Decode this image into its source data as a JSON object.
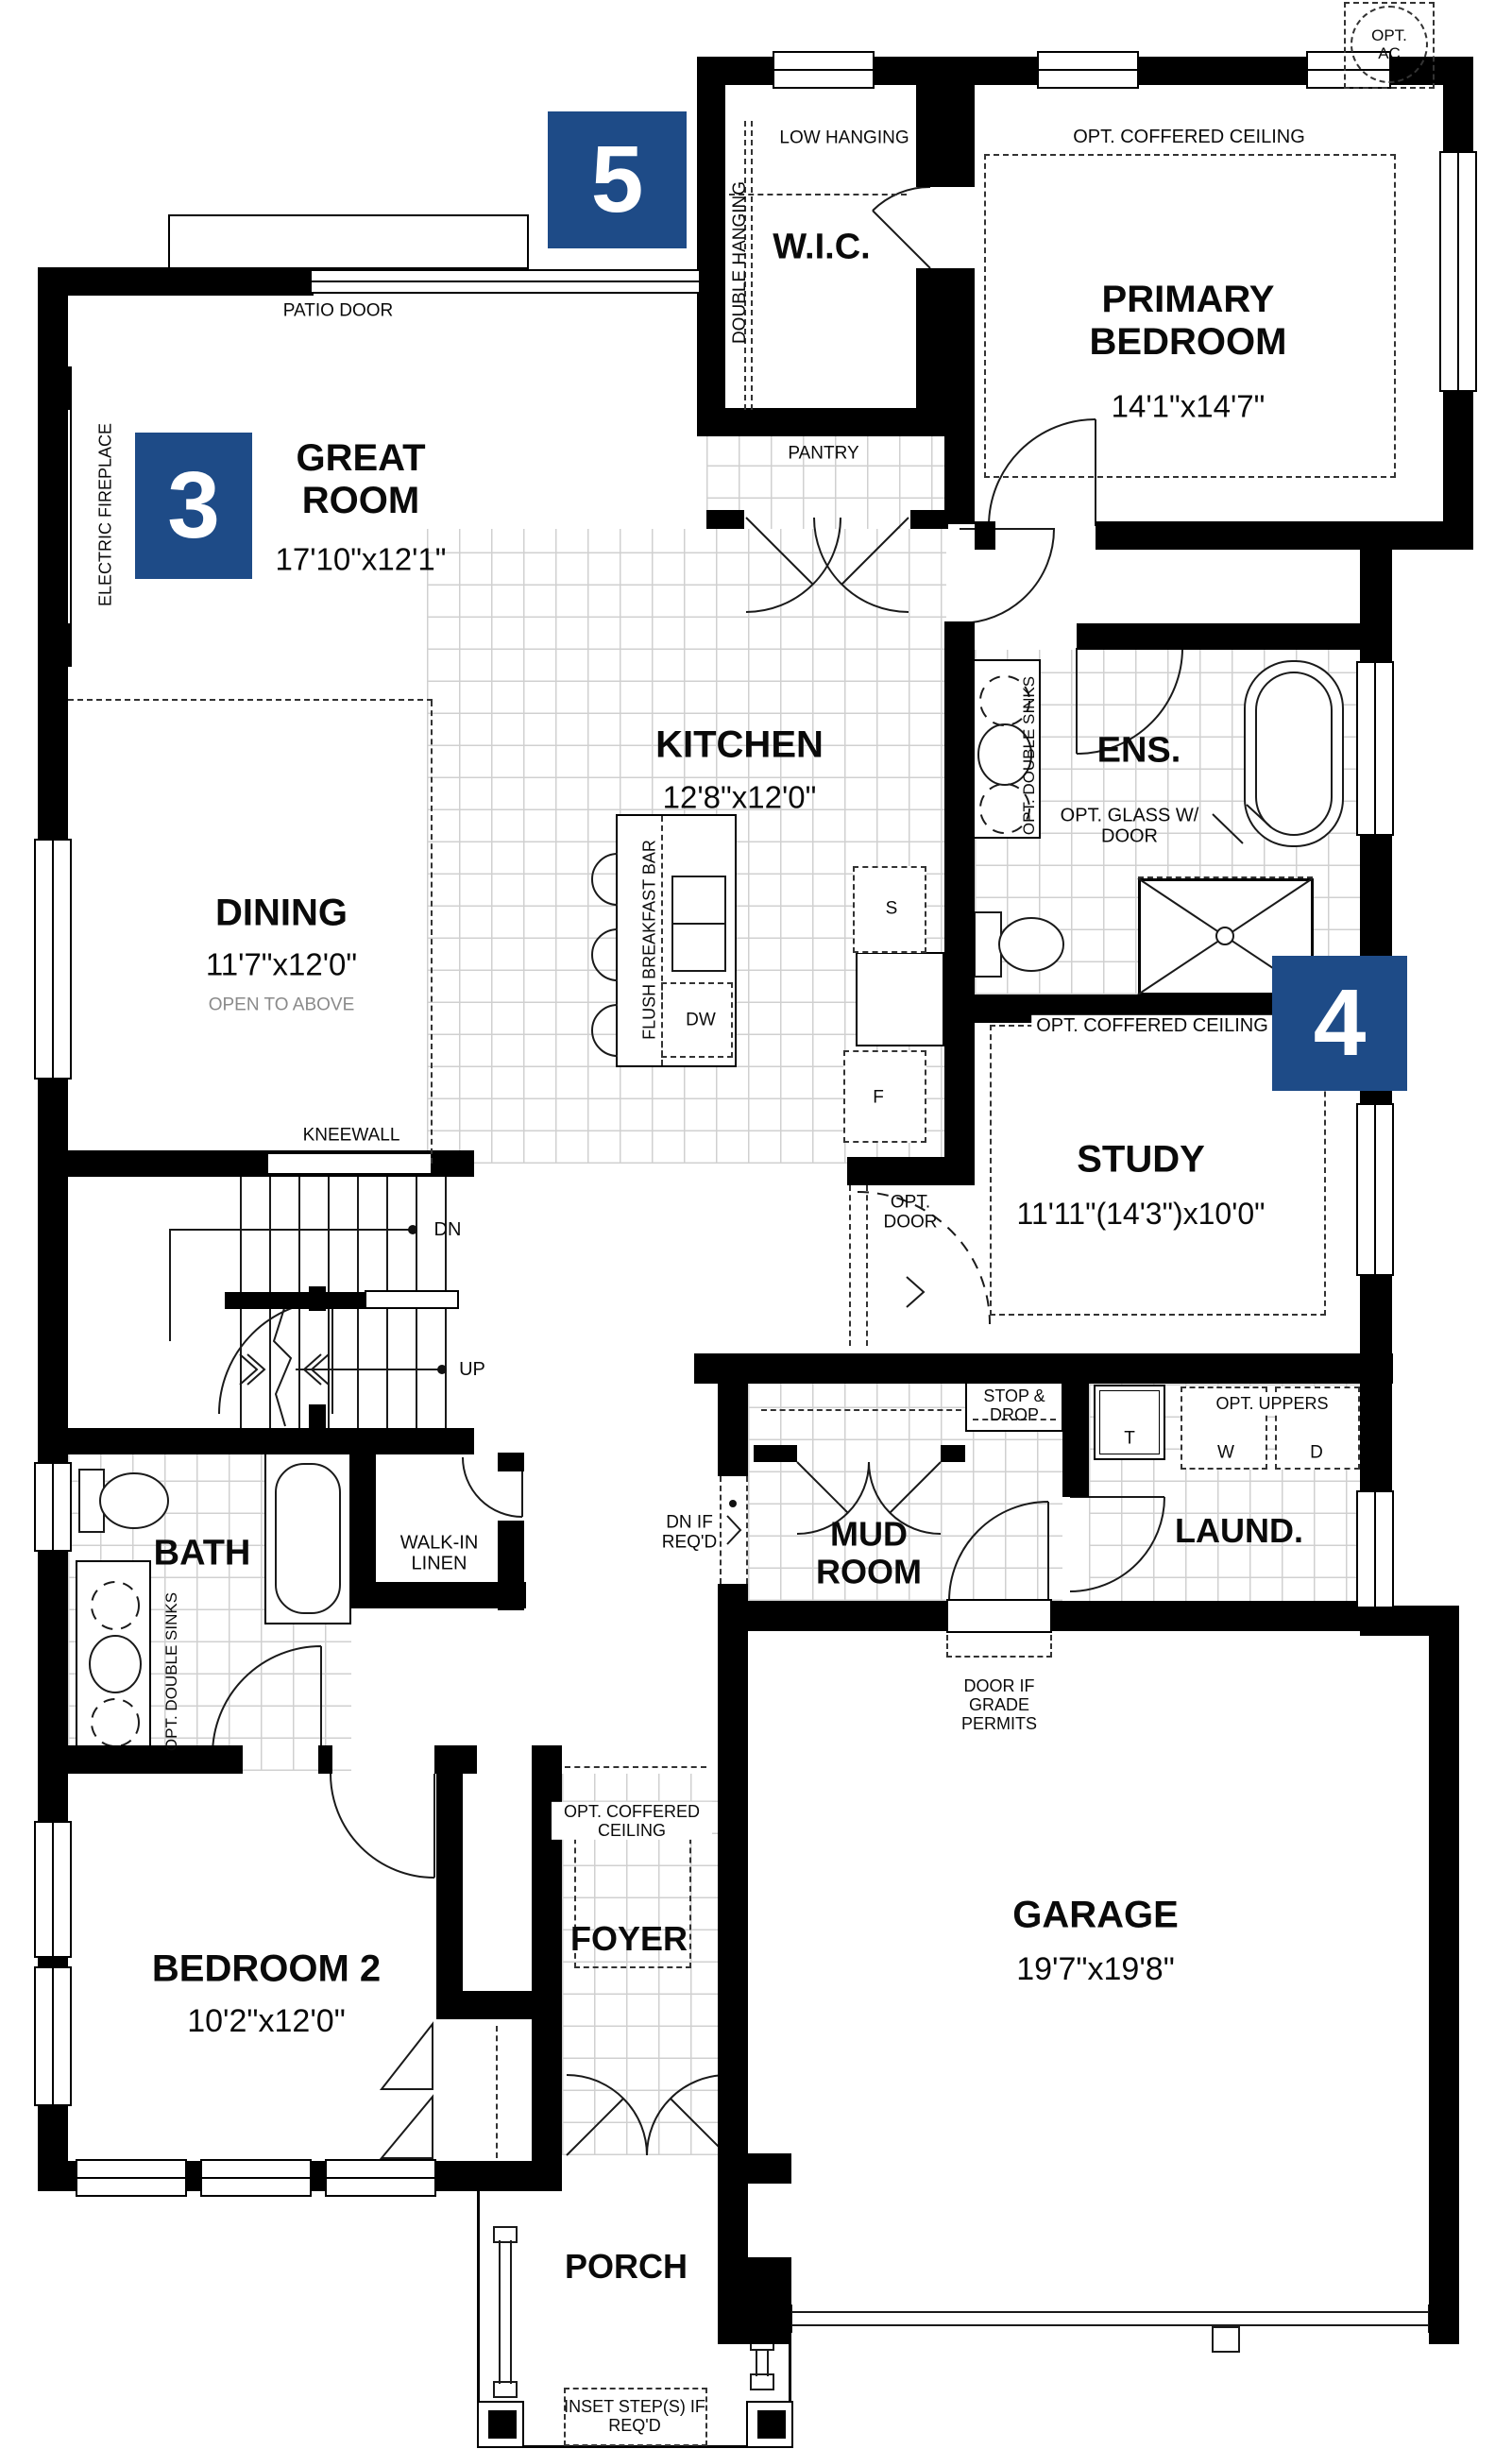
{
  "colors": {
    "marker_blue": "#1e4b87",
    "wall": "#000000"
  },
  "markers": {
    "five": "5",
    "three": "3",
    "four": "4"
  },
  "rooms": {
    "wic": {
      "name": "W.I.C."
    },
    "primary": {
      "name": "PRIMARY BEDROOM",
      "dims": "14'1\"x14'7\""
    },
    "great": {
      "name": "GREAT ROOM",
      "dims": "17'10\"x12'1\""
    },
    "kitchen": {
      "name": "KITCHEN",
      "dims": "12'8\"x12'0\""
    },
    "dining": {
      "name": "DINING",
      "dims": "11'7\"x12'0\"",
      "note": "OPEN TO ABOVE"
    },
    "ens": {
      "name": "ENS."
    },
    "study": {
      "name": "STUDY",
      "dims": "11'11\"(14'3\")x10'0\""
    },
    "bath": {
      "name": "BATH"
    },
    "linen": {
      "name": "WALK-IN LINEN"
    },
    "mud": {
      "name": "MUD ROOM"
    },
    "laund": {
      "name": "LAUND."
    },
    "bedroom2": {
      "name": "BEDROOM 2",
      "dims": "10'2\"x12'0\""
    },
    "foyer": {
      "name": "FOYER"
    },
    "garage": {
      "name": "GARAGE",
      "dims": "19'7\"x19'8\""
    },
    "porch": {
      "name": "PORCH"
    },
    "pantry": {
      "name": "PANTRY"
    }
  },
  "labels": {
    "opt_ac": "OPT. AC",
    "low_hanging": "LOW HANGING",
    "double_hanging": "DOUBLE HANGING",
    "patio_door": "PATIO DOOR",
    "opt_coffered_ceiling": "OPT. COFFERED CEILING",
    "electric_fireplace": "ELECTRIC FIREPLACE",
    "opt_double_sinks": "OPT. DOUBLE SINKS",
    "opt_glass_w_door": "OPT. GLASS W/ DOOR",
    "flush_breakfast_bar": "FLUSH BREAKFAST BAR",
    "kneewall": "KNEEWALL",
    "dn": "DN",
    "up": "UP",
    "opt_door": "OPT. DOOR",
    "stop_drop": "STOP & DROP",
    "opt_uppers": "OPT. UPPERS",
    "dn_if_reqd": "DN IF REQ'D",
    "door_if_grade_permits": "DOOR IF GRADE PERMITS",
    "inset_steps": "INSET STEP(S) IF REQ'D",
    "washer": "W",
    "dryer": "D",
    "tub": "T",
    "dishwasher": "DW",
    "stove": "S",
    "fridge": "F"
  }
}
